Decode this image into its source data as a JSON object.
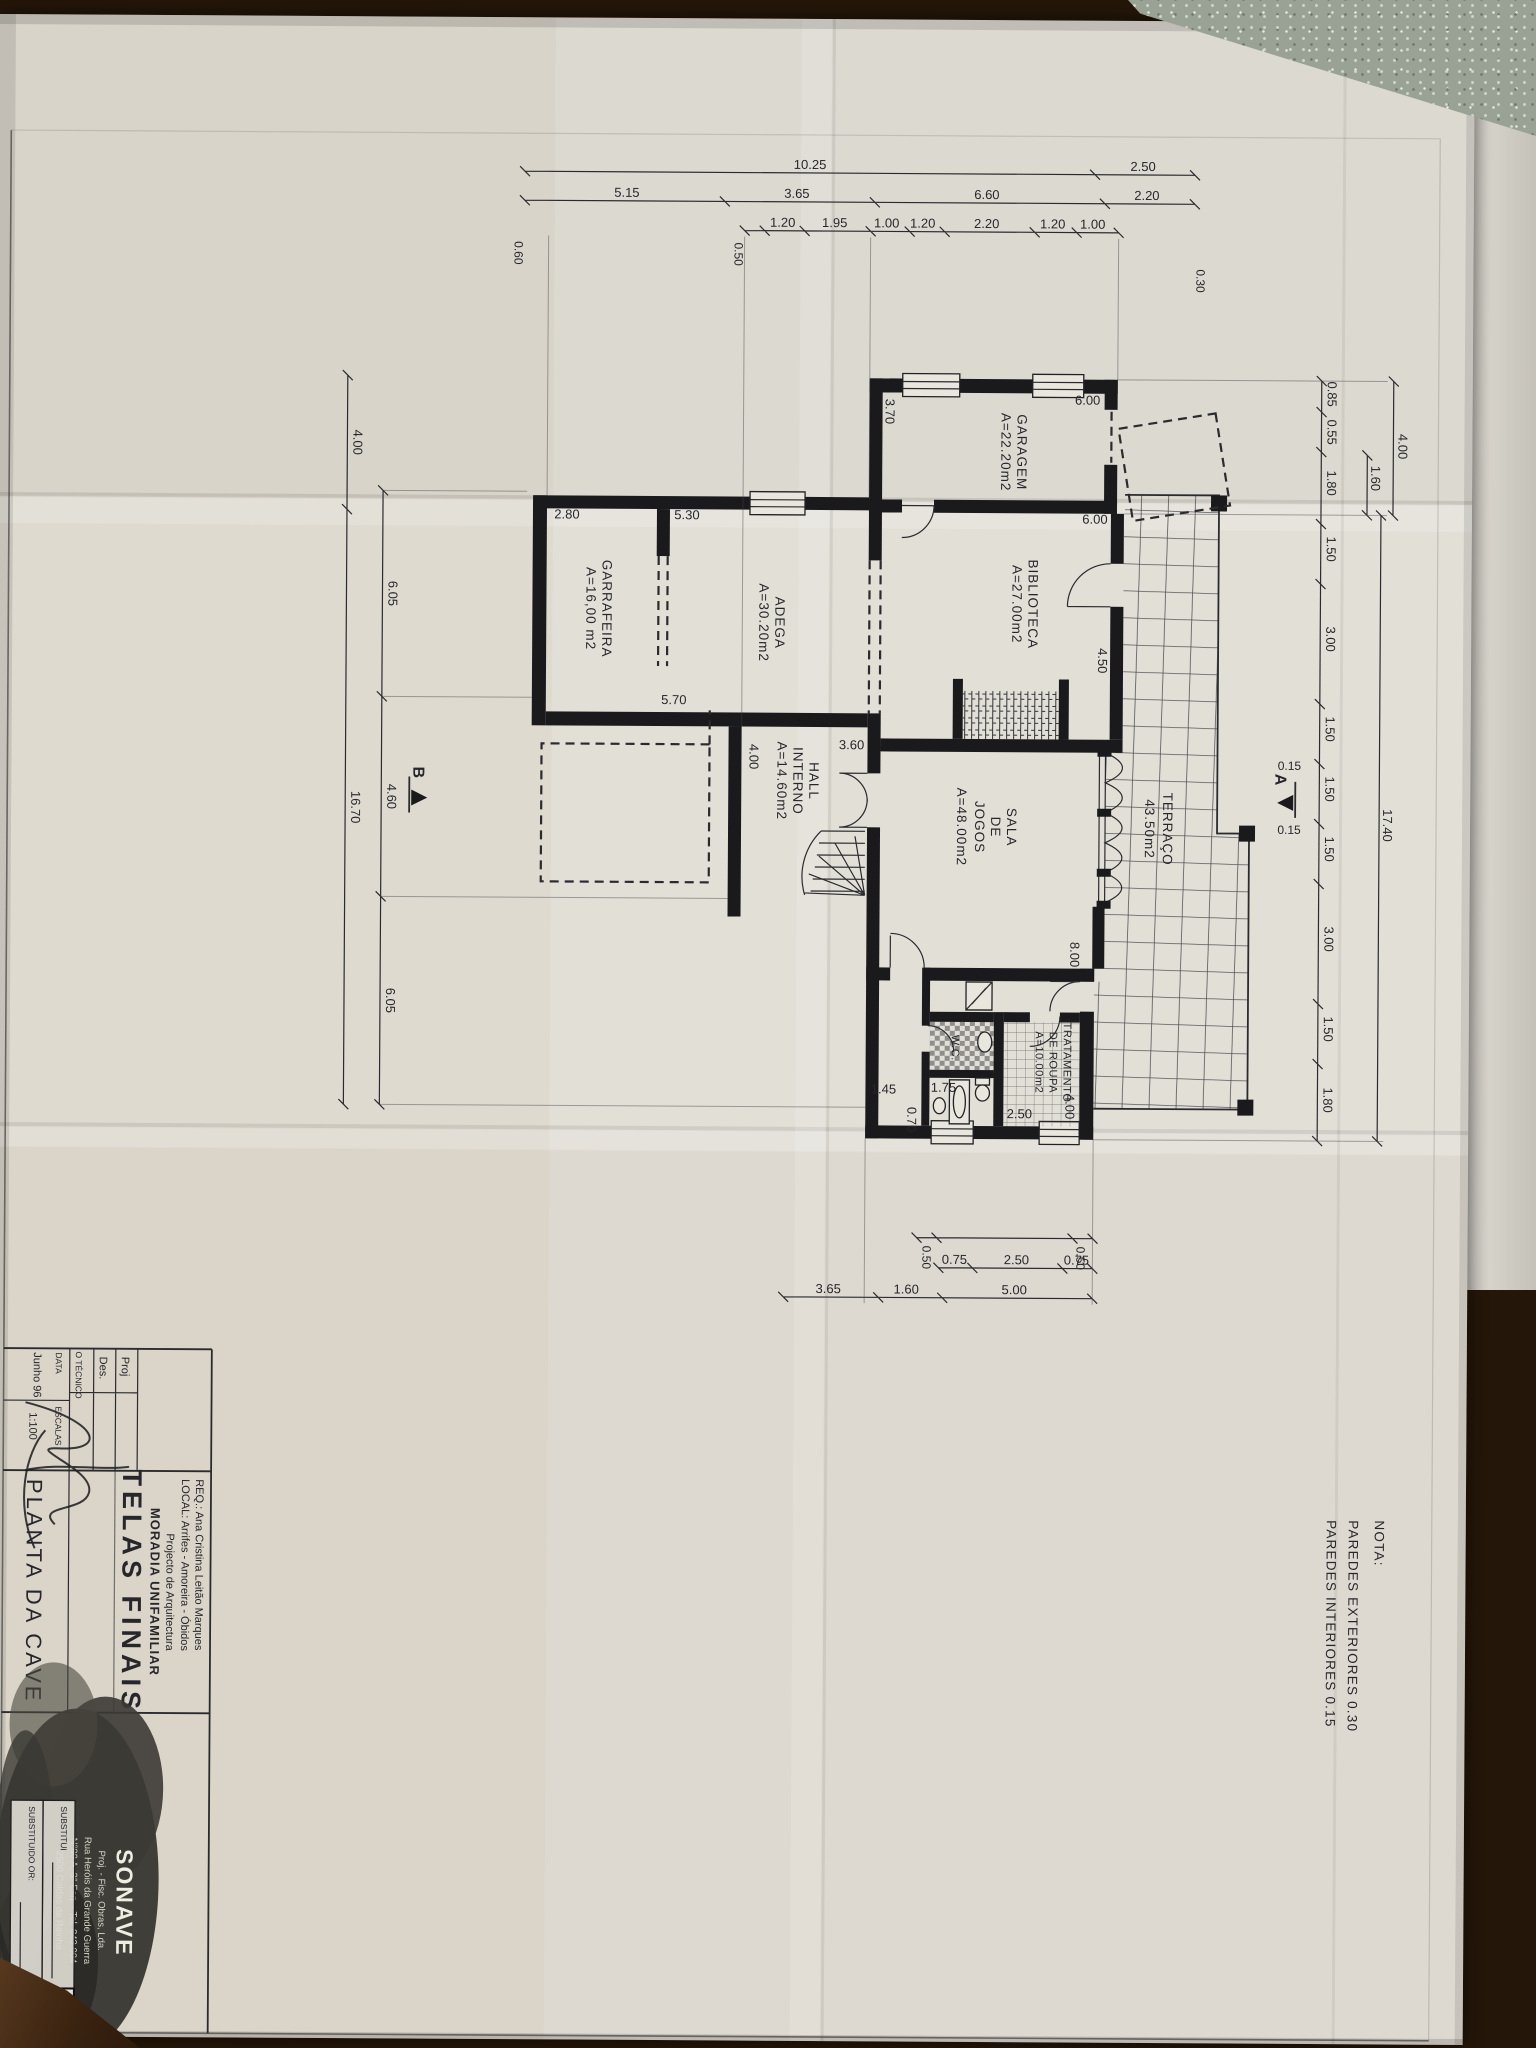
{
  "colors": {
    "paper": "#e2dfd7",
    "ink": "#26262b",
    "wall": "#1a1a1d",
    "table_wood": "#3a2310",
    "granite": "#99a294"
  },
  "nota": {
    "title": "NOTA:",
    "line1": "PAREDES EXTERIORES 0.30",
    "line2": "PAREDES INTERIORES 0.15"
  },
  "rooms": {
    "garagem": {
      "name": "GARAGEM",
      "area": "A=22.20m2"
    },
    "biblioteca": {
      "name": "BIBLIOTECA",
      "area": "A=27.00m2"
    },
    "adega": {
      "name": "ADEGA",
      "area": "A=30.20m2"
    },
    "garrafeira": {
      "name": "GARRAFEIRA",
      "area": "A=16,00 m2"
    },
    "hall": {
      "l1": "HALL",
      "l2": "INTERNO",
      "area": "A=14.60m2"
    },
    "sala": {
      "l1": "SALA",
      "l2": "DE",
      "l3": "JOGOS",
      "area": "A=48.00m2"
    },
    "tratamento": {
      "l1": "TRATAMENTO",
      "l2": "DE ROUPA",
      "area": "A=10.00m2"
    },
    "terraco": {
      "name": "TERRAÇO",
      "area": "43.50m2"
    },
    "wc": {
      "name": "W.C."
    }
  },
  "dims": {
    "top_outer": [
      "4.00",
      "1.60",
      "17.40"
    ],
    "top_inner": [
      "0.85",
      "0.55",
      "1.80",
      "1.50",
      "3.00",
      "1.50",
      "1.50",
      "1.50",
      "3.00",
      "1.50",
      "1.80"
    ],
    "top_wall_marks": [
      "0.15",
      "0.15"
    ],
    "left_outer": [
      "2.50",
      "10.25"
    ],
    "left_mid": [
      "2.20",
      "6.60",
      "3.65",
      "5.15"
    ],
    "left_inner": [
      "1.00",
      "1.20",
      "2.20",
      "1.20",
      "1.00",
      "1.95",
      "1.20"
    ],
    "left_extras": [
      "0.30",
      "0.50",
      "0.60"
    ],
    "bottom_inner": [
      "6.05",
      "4.60",
      "6.05"
    ],
    "bottom_outer": [
      "4.00",
      "16.70"
    ],
    "right_inner": [
      "0.50",
      "0.50"
    ],
    "right_mid": [
      "0.75",
      "2.50",
      "0.75"
    ],
    "right_outer": [
      "5.00",
      "1.60",
      "3.65"
    ],
    "interior": [
      "3.70",
      "6.00",
      "6.00",
      "4.50",
      "5.30",
      "2.80",
      "5.70",
      "3.60",
      "4.00",
      "8.00",
      "4.00",
      "2.50",
      "0.70",
      "1.45",
      "1.75"
    ],
    "sections": {
      "a": "A",
      "b": "B"
    }
  },
  "title_block": {
    "req": "REQ.: Ana Cristina Leitão Marques",
    "local": "LOCAL: Arrifes - Amoreira - Óbidos",
    "project_subtype": "Projecto de Arquitectura",
    "project_type": "MORADIA UNIFAMILIAR",
    "set_title": "TELAS FINAIS",
    "drawing_title": "PLANTA DA CAVE",
    "proj_label": "Proj",
    "des_label": "Des.",
    "tecnico_label": "O TÉCNICO",
    "data_label": "DATA",
    "data_value": "Junho 96",
    "escalas_label": "ESCALAS",
    "escalas_value": "1:100",
    "substitui": "SUBSTITUI",
    "substituido": "SUBSTITUIDO  OR:",
    "sheet_number": "08",
    "stamp": {
      "company": "SONAVE",
      "line1": "Proj. - Fisc. Obras, Lda.",
      "line2": "Rua Heróis da Grande Guerra",
      "line3": "N°80 A, 3° Esq. - Tel. 843 004",
      "line4": "2500 Caldas da Rainha"
    }
  }
}
